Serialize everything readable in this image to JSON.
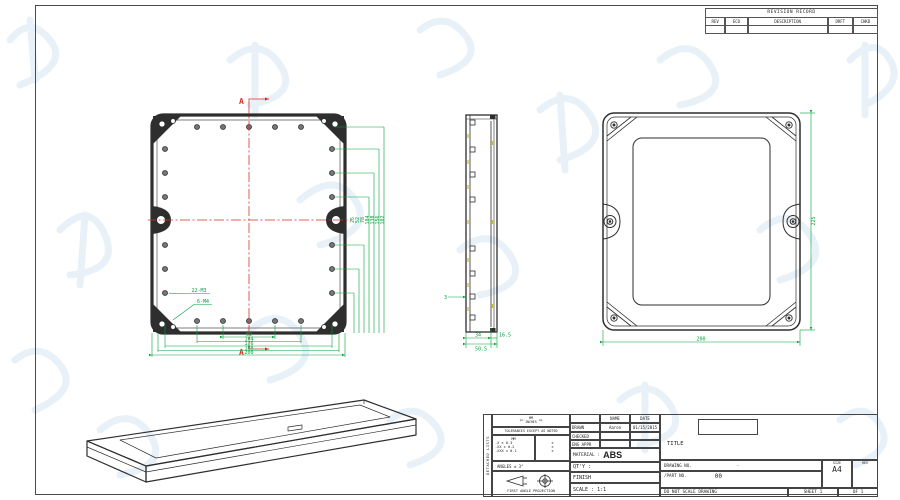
{
  "colors": {
    "drawing_line": "#2e2e2e",
    "dimension_green": "#00a33d",
    "section_red": "#d93025",
    "center_mark_yellow": "#c9bb2e",
    "watermark_blue": "#d6e5f3",
    "frame_border": "#4a4a4a"
  },
  "revision_table": {
    "title": "REVISION RECORD",
    "columns": [
      "REV",
      "ECO",
      "DESCRIPTION",
      "DRFT",
      "CHKD"
    ]
  },
  "front_view": {
    "section_label": "A",
    "holes_label": "22-M3",
    "bosses_label": "6-M4",
    "bottom_dims": [
      "52",
      "104",
      "176",
      "188",
      "200"
    ],
    "right_dims": [
      "26",
      "52",
      "78",
      "104",
      "130",
      "156",
      "182"
    ]
  },
  "side_view": {
    "thickness_dim": "3",
    "bottom_dim_a": "34",
    "bottom_dim_b": "16.5",
    "bottom_dim_total": "50.5"
  },
  "back_view": {
    "width_dim": "200",
    "height_dim": "225"
  },
  "title_block": {
    "side_strip": "DETACHED LISTS",
    "units_top": "MM",
    "units_bottom": "INCHES",
    "tolerance_note": "TOLERANCES EXCEPT AS NOTED",
    "tol_col_header": "MM",
    "tolerances": [
      ".X ± 0.3",
      ".XX ± 0.2",
      ".XXX ± 0.1"
    ],
    "tol_marks": [
      "±",
      "±",
      "±"
    ],
    "angles_note": "ANGLES ± 3°",
    "projection_note": "FIRST ANGLE PROJECTION",
    "name_header": "NAME",
    "date_header": "DATE",
    "drawn_label": "DRAWN",
    "drawn_name": "Aaron",
    "drawn_date": "01/15/2015",
    "checked_label": "CHECKED",
    "eng_appr_label": "ENG APPR",
    "material_label": "MATERIAL :",
    "material_value": "ABS",
    "qty_label": "QT'Y :",
    "finish_label": "FINISH",
    "scale_label": "SCALE : 1:1",
    "title_label": "TITLE",
    "drawing_no_label": "DRAWING NO.",
    "drawing_no_value": "-",
    "part_no_label": "/PART NO.",
    "part_no_value": "00",
    "size_label": "SIZE",
    "size_value": "A4",
    "rev_label": "REV",
    "do_not_scale": "DO NOT SCALE DRAWING",
    "sheet_label": "SHEET 1",
    "of_label": "OF 1"
  }
}
